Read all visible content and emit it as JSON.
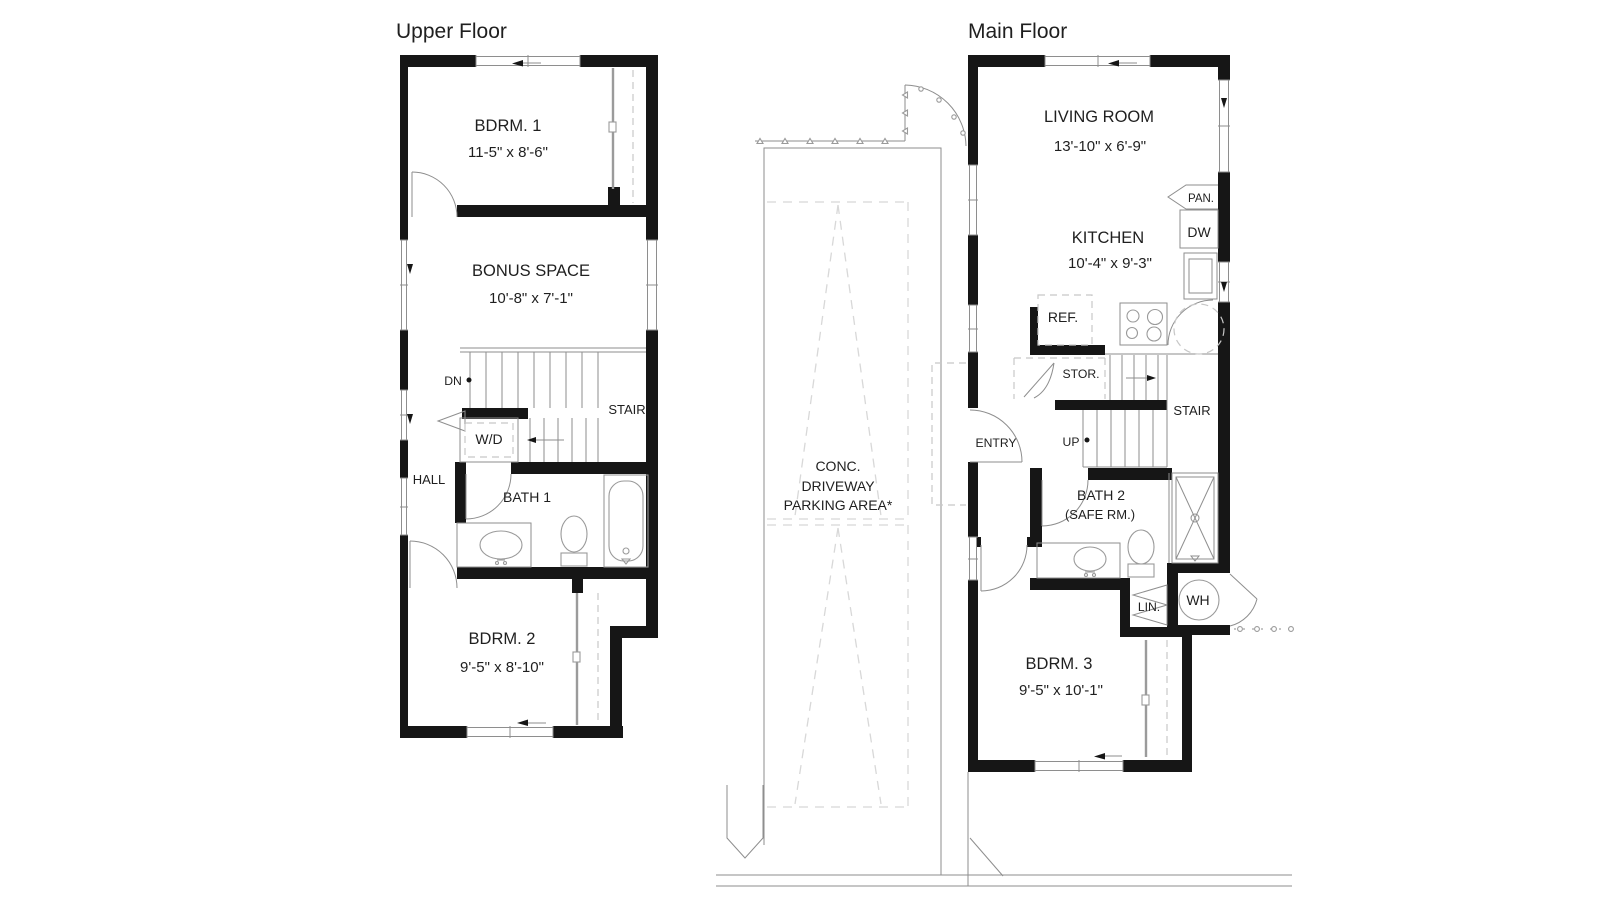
{
  "colors": {
    "wall": "#161616",
    "thin": "#8e8e8e",
    "fix": "#9a9a9a",
    "dash": "#c7c7c7",
    "dash2": "#d8d8d8",
    "text": "#1f1f1f"
  },
  "upper_floor": {
    "title": "Upper Floor",
    "bdrm1": {
      "label": "BDRM. 1",
      "dims": "11-5\" x 8'-6\""
    },
    "bonus": {
      "label": "BONUS SPACE",
      "dims": "10'-8\" x 7'-1\""
    },
    "stair": {
      "label": "STAIR",
      "dn": "DN"
    },
    "wd": {
      "label": "W/D"
    },
    "hall": {
      "label": "HALL"
    },
    "bath1": {
      "label": "BATH 1"
    },
    "bdrm2": {
      "label": "BDRM. 2",
      "dims": "9'-5\" x 8'-10\""
    }
  },
  "main_floor": {
    "title": "Main Floor",
    "living": {
      "label": "LIVING ROOM",
      "dims": "13'-10\" x 6'-9\""
    },
    "kitchen": {
      "label": "KITCHEN",
      "dims": "10'-4\" x 9'-3\"",
      "pan": "PAN.",
      "dw": "DW",
      "ref": "REF."
    },
    "stor": {
      "label": "STOR."
    },
    "stair": {
      "label": "STAIR",
      "up": "UP"
    },
    "entry": {
      "label": "ENTRY"
    },
    "bath2": {
      "label": "BATH 2",
      "sub": "(SAFE RM.)"
    },
    "lin": {
      "label": "LIN."
    },
    "wh": {
      "label": "WH"
    },
    "bdrm3": {
      "label": "BDRM. 3",
      "dims": "9'-5\" x 10'-1\""
    }
  },
  "site": {
    "driveway_line1": "CONC.",
    "driveway_line2": "DRIVEWAY",
    "driveway_line3": "PARKING AREA*"
  }
}
